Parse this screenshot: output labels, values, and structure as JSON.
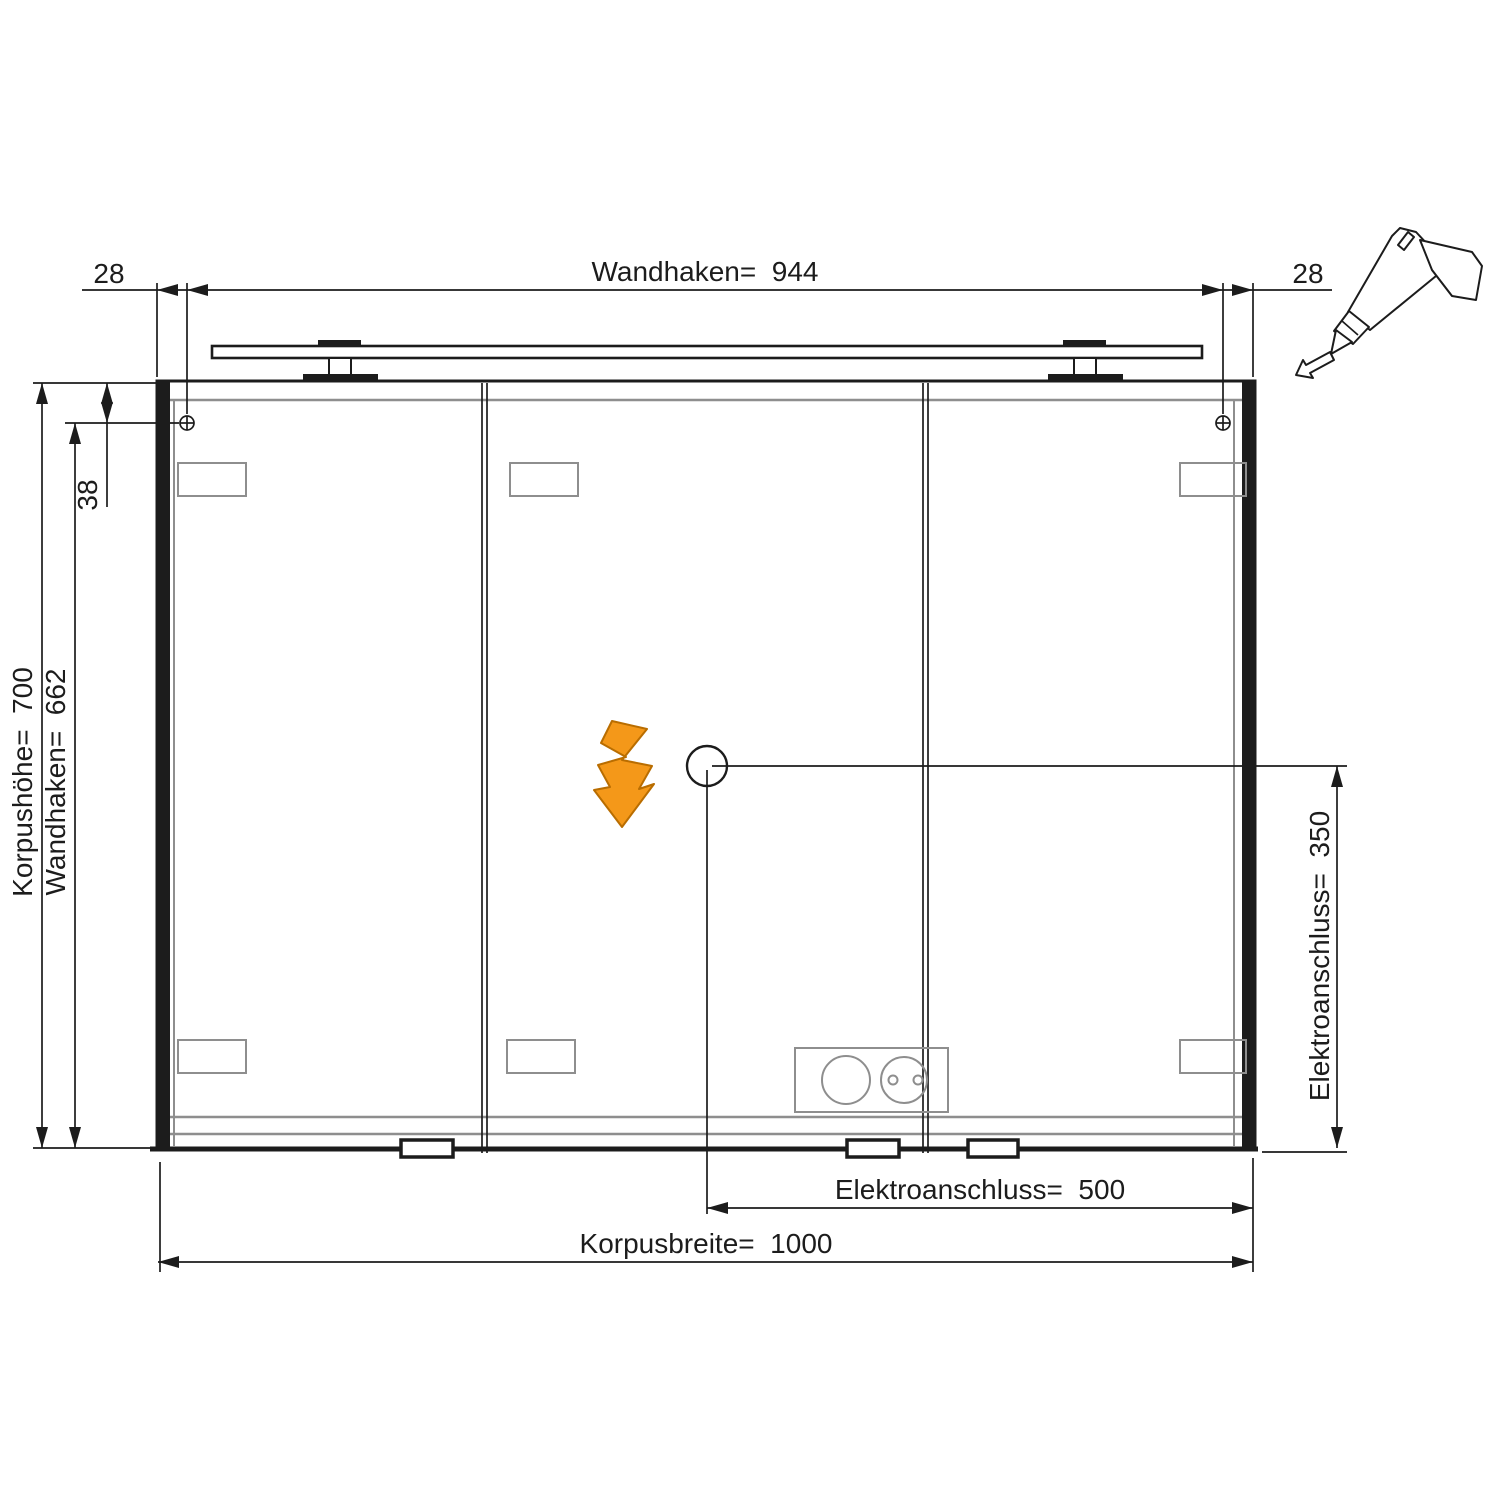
{
  "dimensions": {
    "offset_left": "28",
    "offset_right": "28",
    "wall_hook_width": "Wandhaken=  944",
    "body_height": "Korpushöhe=  700",
    "wall_hook_height": "Wandhaken=  662",
    "hook_top_inset": "38",
    "electrical_height": "Elektroanschluss=  350",
    "electrical_width": "Elektroanschluss=  500",
    "body_width": "Korpusbreite=  1000"
  },
  "colors": {
    "line": "#1c1c1c",
    "secondary_line": "#8e8e8e",
    "accent": "#f49819",
    "background": "#ffffff"
  },
  "icons": [
    {
      "name": "drill-icon"
    },
    {
      "name": "lightning-bolt-icon"
    },
    {
      "name": "screw-marker-icon"
    },
    {
      "name": "socket-outlet-icon"
    }
  ]
}
